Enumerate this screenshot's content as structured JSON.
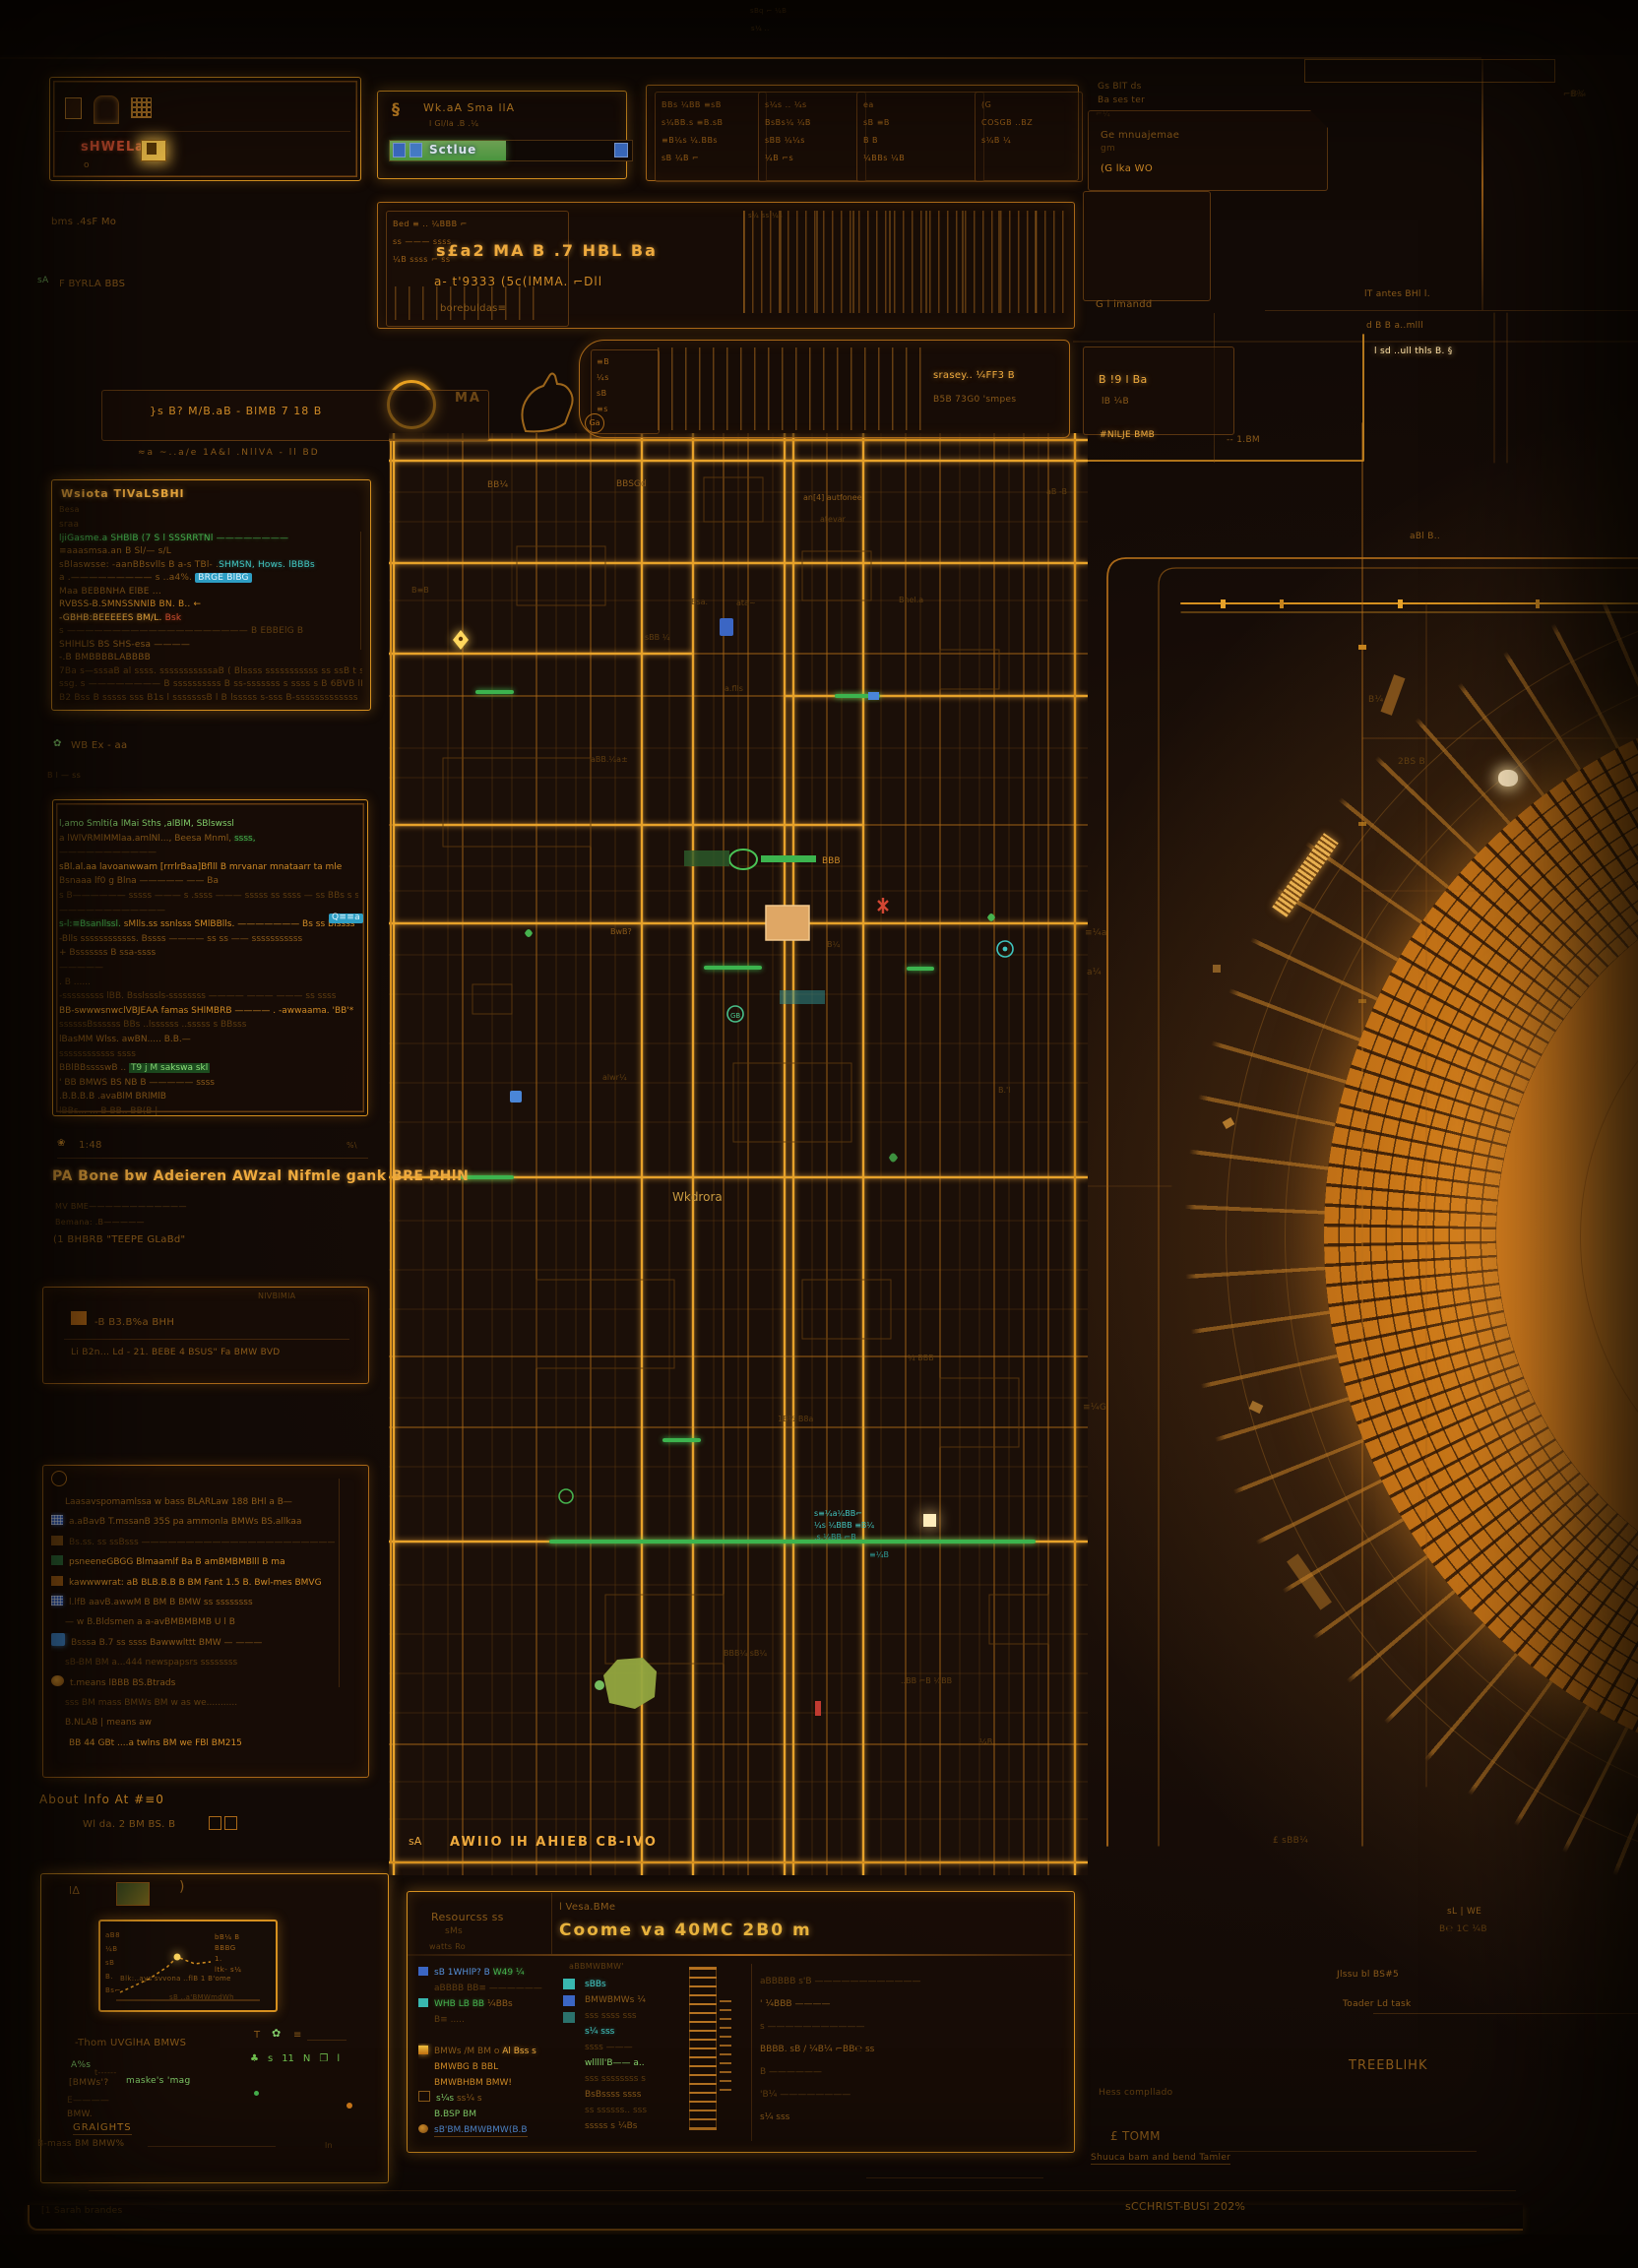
{
  "palette": {
    "bg": "#150c07",
    "line": "#a96818",
    "line_bright": "#e7a22a",
    "text": "#b97a22",
    "green": "#46b24e",
    "cyan": "#41c6c0",
    "blue": "#5590da",
    "red": "#cf4f30",
    "pale": "#ffe2a8"
  },
  "top": {
    "tiny1": "sBq ⌐ ¼B",
    "tiny2": "s¼ ..",
    "band_left": {
      "red_text": "sHWELa.",
      "small_o": "o",
      "row2": "bms  .4sF Mo",
      "row3a": "sA",
      "row3b": "F BYRLA BBS"
    },
    "mid": {
      "logo": "§",
      "title": "Wk.aA Sma llA",
      "subtitle": "l Gl/la   .B  .¼",
      "progress_label": "Sctlue",
      "progress_pct": 48
    },
    "toolbar": {
      "boxes": [
        {
          "rows": [
            "BBs ¼BB ≡sB",
            "s¼BB.s ≡B.sB",
            "≡B¼s ¼.BBs",
            "sB ¼B ⌐"
          ]
        },
        {
          "rows": [
            "s¼s .. ¼s",
            "BsBs¼ ¼B",
            "sBB ¼¼s",
            "¼B ⌐s"
          ]
        },
        {
          "rows": [
            "ea",
            "sB ≡B",
            "B   B",
            "¼BBs ¼B"
          ]
        },
        {
          "rows": [
            "(G",
            "COSGB ..BZ",
            "s¼B ¼"
          ]
        }
      ]
    },
    "right": {
      "c1a": "Gs BlT ds",
      "c1b": "Ba ses ter",
      "c1c": "⌐¼",
      "c2a": "Ge mnuajemae",
      "c2b": "gm",
      "c2c": "(G   lka  WO",
      "c3": "G l imandd",
      "c4a": "lT antes BHl l.",
      "c4b": "d B B a..mlll",
      "c4c": "l sd ..ull thls B. §",
      "c5": "⌐B¼"
    }
  },
  "strip2": {
    "left_rows": [
      "Bed ≡ .. ¼BBB ⌐",
      "ss ——— ssss",
      "¼B ssss ⌐ ss"
    ],
    "bold1": "s£a2  MA B   .7   HBL  Ba",
    "bold2": "a- t'9333  (5c(lMMA. ⌐Dll",
    "bold3": "borebuldas≡",
    "bc_top": "s¼ ss ¼s"
  },
  "row3": {
    "za": "MA",
    "ga": "Ga",
    "box_text": "}s B?  M/B.aB - BlMB 7 18 B",
    "glyphcol": [
      "≡B",
      "¼s",
      "sB",
      "≡s"
    ],
    "p1": "srasey.. ¼FF3 B",
    "p2": "B5B 73G0 'smpes",
    "r1": "B !9 l Ba",
    "r2": "lB ¼B"
  },
  "left": {
    "line": "≈a  ~..a/e  1A&l  .NllVA  -  ll  BD",
    "panel1": {
      "header": "Wsiota TlVaLSBHl",
      "sub": "Besa",
      "rows": [
        {
          "t": "sraa",
          "c": "faint",
          "t2": "",
          "c2": ""
        },
        {
          "t": "ljiGasme.a SHBlB   (7 S l SSSRRTNl ————————",
          "c": "green",
          "t2": "",
          "c2": ""
        },
        {
          "t": "≡aaasmsa.an B   Sl/—  s/L",
          "c": "dim",
          "t2": "",
          "c2": ""
        },
        {
          "t": "sBlaswsse: -aanBBsvlls B a-s TBl- .",
          "c": "dim",
          "t2": "SHMSN, Hows. lBBBs",
          "c2": "cyan"
        },
        {
          "t": "a .————————— s   ..a4%. ",
          "c": "dim",
          "t2": "BRGE BlBG",
          "c2": "chipcyan"
        },
        {
          "t": "Maa BEBBNHA ElBE ...",
          "c": "dim",
          "t2": "",
          "c2": ""
        },
        {
          "t": "RVBSS-B.SMNSSNNlB BN. B..  ←",
          "c": "orange",
          "t2": "",
          "c2": ""
        },
        {
          "t": "-GBHB:BEEEEES BM/L. ",
          "c": "bright",
          "t2": "Bsk",
          "c2": "red"
        },
        {
          "t": "s ————————————————————   B EBBElG B",
          "c": "faint",
          "t2": "",
          "c2": ""
        },
        {
          "t": "SHlHLlS BS SHS-esa ————",
          "c": "dim",
          "t2": "",
          "c2": ""
        },
        {
          "t": "          -.B    BMBBBBLABBBB",
          "c": "dim",
          "t2": "",
          "c2": ""
        },
        {
          "t": "7Ba s—sssaB al ssss. sssssssssssaB ( Blssss  sssssssssss ss ssB t sssssB",
          "c": "faint",
          "t2": "",
          "c2": ""
        },
        {
          "t": "ssg. s ———————— B ssssssssss B ss-sssssss s ssss s B 6BVB lBssss sssss ss ss",
          "c": "faint",
          "t2": "",
          "c2": ""
        },
        {
          "t": "B2   Bss B sssss sss B1s l sssssssB l B lsssss  s-sss B-sssssssssssss",
          "c": "faint",
          "t2": "",
          "c2": ""
        }
      ]
    },
    "mid_label": "WB Ex - aa",
    "mid_label2": "B l — ss",
    "panel2": {
      "badge": "Q≡≡a",
      "rows": [
        {
          "t": "l,amo Smlti(a lMai Sths  ,alBlM,  SBlswssl",
          "c": "green2",
          "t2": "",
          "c2": ""
        },
        {
          "t": "a lWlVRMlMMlaa.amlNl..., Beesa Mnml, ",
          "c": "dim",
          "t2": "ssss,",
          "c2": "green"
        },
        {
          "t": "———————————",
          "c": "faint",
          "t2": "",
          "c2": ""
        },
        {
          "t": "sBl.al.aa lavoanwwam [rrrlrBaa]Bflll B mrvanar     mnataarr ta mle",
          "c": "orange",
          "t2": "",
          "c2": ""
        },
        {
          "t": "Bsnaaa lf0 g Blna ————— —— Ba",
          "c": "dim",
          "t2": "",
          "c2": ""
        },
        {
          "t": "s B—————— sssss ——— s .ssss ——— sssss ss ssss — ss BBs s sss-BBs",
          "c": "faint",
          "t2": "",
          "c2": ""
        },
        {
          "t": "————————————",
          "c": "faint",
          "t2": "",
          "c2": ""
        },
        {
          "t": "s-l:≡Bsanllssl.  ",
          "c": "green",
          "t2": "sMlls.ss ssnlsss SMlBBlls. ——————— Bs ss Blssss",
          "c2": "orange"
        },
        {
          "t": "-Blls ssssssssssss. Bssss ———— ss ss —— sssssssssss",
          "c": "dim",
          "t2": "",
          "c2": ""
        },
        {
          "t": "+ Bsssssss B ssa-ssss",
          "c": "dim",
          "t2": "",
          "c2": ""
        },
        {
          "t": "—————",
          "c": "faint",
          "t2": "",
          "c2": ""
        },
        {
          "t": ". B ......",
          "c": "faint",
          "t2": "",
          "c2": ""
        },
        {
          "t": "-sssssssss lBB. Bsslsssls-ssssssss ———— ——— ——— ss ssss",
          "c": "faint",
          "t2": "",
          "c2": ""
        },
        {
          "t": "BB-swwwsnwclVBJEAA famas SHlMBRB ———— . -awwaama. 'BB'*",
          "c": "orange",
          "t2": "",
          "c2": ""
        },
        {
          "t": "ssssssBssssss BBs ..lssssss ..sssss s BBsss",
          "c": "faint",
          "t2": "",
          "c2": ""
        },
        {
          "t": "lBasMM Wlss. awBN..... B.B.—",
          "c": "dim",
          "t2": "",
          "c2": ""
        },
        {
          "t": "ssssssssssss ssss",
          "c": "faint",
          "t2": "",
          "c2": ""
        },
        {
          "t": "BBlBBsssswB .. ",
          "c": "dim",
          "t2": "T9 j M sakswa skl",
          "c2": "greenchip"
        },
        {
          "t": "' BB  BMWS BS NB B ————— ssss",
          "c": "dim",
          "t2": "",
          "c2": ""
        },
        {
          "t": ".B.B.B.B    .avaBlM    BRlMlB",
          "c": "dim",
          "t2": "",
          "c2": ""
        },
        {
          "t": "lBBs... ... B BB.. BB(B |",
          "c": "faint",
          "t2": "",
          "c2": ""
        }
      ]
    },
    "block3": {
      "time": "1:48",
      "mark": "%\\",
      "headline": "PA  Bone bw Adeieren AWzal Nifmle  gank  BRE PHlN",
      "l2": "MV BME————————————",
      "l3": "Bemana: .B—————",
      "l4": "(1 BHBRB  \"TEEPE  GLaBd\""
    },
    "panel3": {
      "corner": "NlVBlMlA",
      "row1": "-B B3.B%a    BHH",
      "row2": "Li B2n... Ld - 21.  BEBE 4 BSUS\"  Fa BMW BVD"
    },
    "panel4": {
      "rows": [
        {
          "ic": "none",
          "t": "Laasavspomamlssa w bass BLARLaw 188 BHl a B—",
          "c": "dim"
        },
        {
          "ic": "qr",
          "t": "a.aBavB T.mssanB 35S pa ammonla BMWs BS.allkaa",
          "c": "dim"
        },
        {
          "ic": "chip",
          "t": "Bs.ss.  ss ssBsss ———————————————————————— s",
          "c": "faint"
        },
        {
          "ic": "mini",
          "t": "psneeneGBGG Blmaamlf Ba B amBMBMBlll B ma",
          "c": "orange"
        },
        {
          "ic": "chip2",
          "t": "kawwwwrat: aB BLB.B.B B BM Fant 1.5 B. Bwl-mes BMVG",
          "c": "orange"
        },
        {
          "ic": "qr",
          "t": "l.lfB aavB.awwM B BM B BMW ss ssssssss",
          "c": "dim"
        },
        {
          "ic": "none",
          "t": "— w B.Bldsmen a a-avBMBMBMB U l B",
          "c": "dim"
        },
        {
          "ic": "phone",
          "t": "Bsssa B.7     ss ssss Bawwwlttt BMW — ———",
          "c": "dim"
        },
        {
          "ic": "none",
          "t": "sB-BM BM a...444 newspapsrs ssssssss",
          "c": "faint"
        },
        {
          "ic": "swirl",
          "t": "t.means lBBB BS.Btrads",
          "c": "dim"
        },
        {
          "ic": "none",
          "t": "sss BM mass BMWs BM w as we...........",
          "c": "faint"
        },
        {
          "ic": "none",
          "t": "B.NLAB | means aw",
          "c": "dim"
        },
        {
          "ic": "icons",
          "t": "BB 44 GBt    ....a twlns BM we FBl BM215",
          "c": "orange"
        }
      ]
    },
    "below_title": "About lnfo At #≡0",
    "below_line": "Wl da. 2 BM BS. B"
  },
  "bottom_left": {
    "h1": "lΔ",
    "h2": ")",
    "yticks": [
      "aB8",
      "¼B",
      "sB",
      "B.",
      "Bs⌐"
    ],
    "right_rows": [
      "bB¼ B",
      "BBBG",
      "1.",
      "ltk- s¼"
    ],
    "caption": "Blk:..ays svvona ..flB 1 B'ome",
    "sub": "sB ..a'BMWmdWh",
    "row_label": "-Thom UVGlHA  BMWS",
    "ic1": "T",
    "ic2": "✿",
    "ic3": "≡",
    "lr1a": "A%s",
    "lr1b": "t------",
    "green_icons": [
      "♣",
      "s",
      "11",
      "N",
      "❐",
      "l"
    ],
    "lr2a": "[BMWs'?",
    "lr2b": "maske's 'mag",
    "lr3": "E————",
    "lr4a": "BMW.",
    "lr4b": "GRAlGHTS",
    "bottom": "B-mass BM BMW%",
    "bottom2": "ln"
  },
  "bottom_center": {
    "hl1": "Resourcss ss",
    "hl2": "sMs",
    "hl3": "watts Ro",
    "hr1": "l Vesa.BMe",
    "hr2": "Coome va 40MC 2B0 m",
    "col1": [
      {
        "ic": "chipb",
        "t": "sB 1WHlP? B ",
        "c": "blue",
        "t2": "W49 ¼",
        "c2": "green"
      },
      {
        "ic": "none",
        "t": "aBBBB BB≡ ——————",
        "c": "faint",
        "t2": "",
        "c2": ""
      },
      {
        "ic": "chipc",
        "t": "WHB LB BB ",
        "c": "green",
        "t2": "¼BBs",
        "c2": "dim"
      },
      {
        "ic": "none",
        "t": "B≡ .....",
        "c": "faint",
        "t2": "",
        "c2": ""
      },
      {
        "ic": "none",
        "t": "",
        "c": "faint",
        "t2": "",
        "c2": ""
      },
      {
        "ic": "flag",
        "t": "BMWs /M BM o ",
        "c": "dim",
        "t2": "Al Bss s",
        "c2": "bright"
      },
      {
        "ic": "none",
        "t": "BMWBG B BBL",
        "c": "orange",
        "t2": "",
        "c2": ""
      },
      {
        "ic": "none",
        "t": "BMWBHBM BMW!",
        "c": "orange",
        "t2": "",
        "c2": ""
      },
      {
        "ic": "win",
        "t": "s¼s ",
        "c": "green2",
        "t2": "ss¼ s",
        "c2": "dim"
      },
      {
        "ic": "none",
        "t": "B.BSP BM",
        "c": "green2",
        "t2": "",
        "c2": ""
      },
      {
        "ic": "swirl",
        "t": "sB'BM.BMWBMW(B.B",
        "c": "blue u",
        "t2": "",
        "c2": ""
      }
    ],
    "col2_head": "aBBMWBMW'",
    "col2": [
      {
        "t": "sBBs",
        "c": "cyan"
      },
      {
        "t": "BMWBMWs ¼",
        "c": "dim"
      },
      {
        "t": "sss ssss sss",
        "c": "faint"
      },
      {
        "t": "s¼ sss",
        "c": "cyan"
      },
      {
        "t": "ssss ———",
        "c": "faint"
      },
      {
        "t": "wlllll'B—— a..",
        "c": "green2"
      },
      {
        "t": "sss ssssssss s",
        "c": "faint"
      },
      {
        "t": "BsBssss ssss",
        "c": "dim"
      },
      {
        "t": "ss ssssss.. sss",
        "c": "faint"
      },
      {
        "t": "sssss s ¼Bs",
        "c": "dim"
      }
    ],
    "col3": [
      {
        "t": "aBBBBB   s'B ————————————",
        "c": "faint"
      },
      {
        "t": "' ¼BBB ————",
        "c": "dim"
      },
      {
        "t": "s ———————————",
        "c": "faint"
      },
      {
        "t": "BBBB. sB / ¼B¼ ⌐BB℮ ss",
        "c": "dim"
      },
      {
        "t": "B ——————",
        "c": "faint"
      },
      {
        "t": "'B¼ ————————",
        "c": "faint"
      },
      {
        "t": "s¼ sss",
        "c": "dim"
      }
    ]
  },
  "bottom_right": {
    "items": [
      {
        "st": "left:1470px;top:1938px",
        "t": "sL | WE",
        "c": "dim"
      },
      {
        "st": "left:1462px;top:1956px",
        "t": "B℮ 1C ¼B",
        "c": "faint"
      },
      {
        "st": "left:1293px;top:1866px",
        "t": "£ sBB¼",
        "c": "faint"
      },
      {
        "st": "left:1358px;top:2002px",
        "t": "Jlssu bl BS#5",
        "c": "dim"
      },
      {
        "st": "left:1364px;top:2032px",
        "t": "Toader Ld task",
        "c": "dim"
      },
      {
        "st": "left:1370px;top:2092px;font-size:13px;letter-spacing:1px",
        "t": "TREEBLlHK",
        "c": "dim"
      },
      {
        "st": "left:1116px;top:2122px",
        "t": "Hess compllado",
        "c": "faint"
      },
      {
        "st": "left:1128px;top:2164px;font-size:12px",
        "t": "£  TOMM",
        "c": "dim"
      },
      {
        "st": "left:1108px;top:2188px",
        "t": "Shuuca bam and bend Tamler",
        "c": "dim u"
      },
      {
        "st": "left:1143px;top:2236px;font-size:11px",
        "t": "sCCHRlST-BUSl 202%",
        "c": "orange"
      },
      {
        "st": "left:1420px;top:770px",
        "t": "2BS B",
        "c": "faint"
      }
    ]
  },
  "traces": {
    "labels": [
      {
        "st": "left:1117px;top:438px",
        "t": "#NlLJE BMB",
        "c": "bright"
      },
      {
        "st": "left:1246px;top:443px",
        "t": "-- 1.BM",
        "c": "dim"
      },
      {
        "st": "left:1432px;top:541px",
        "t": "aBl B..",
        "c": "dim"
      },
      {
        "st": "left:1390px;top:707px",
        "t": "B¼",
        "c": "faint"
      },
      {
        "st": "left:1102px;top:944px",
        "t": "≡¼a",
        "c": "faint"
      },
      {
        "st": "left:1104px;top:984px",
        "t": "a¼",
        "c": "faint"
      },
      {
        "st": "left:1100px;top:1426px",
        "t": "≡¼G",
        "c": "faint"
      },
      {
        "st": "left:1588px;top:92px",
        "t": "⌐B¼",
        "c": "faint"
      }
    ]
  },
  "map": {
    "street": "Wkdrora",
    "caption_mark": "sA",
    "caption": "AWIIO IH AHIEB  CB-IVO",
    "labels": [
      "BB¼",
      "BBSGd",
      "an[4] autfonee",
      "atevar",
      "aB -B",
      "B≡B",
      "Bsa.",
      "ata~",
      "Bnel.a",
      "a.flls",
      "aBB.¼a±",
      "BwB?",
      "B¼",
      "alwr¼",
      "B.'l",
      "¼ BBB",
      "1B½ B8a",
      "s≡¼a¼BB⌐",
      "¼s ¼BBB ≡B¼",
      ".s.¼BB ⌐B",
      "≡¼B",
      "BBB¼ sB¼",
      "..BB ⌐B ¼BB",
      "¼B",
      "sBB ¼"
    ]
  },
  "footer": {
    "strip": "[1 Sarah brandes"
  }
}
